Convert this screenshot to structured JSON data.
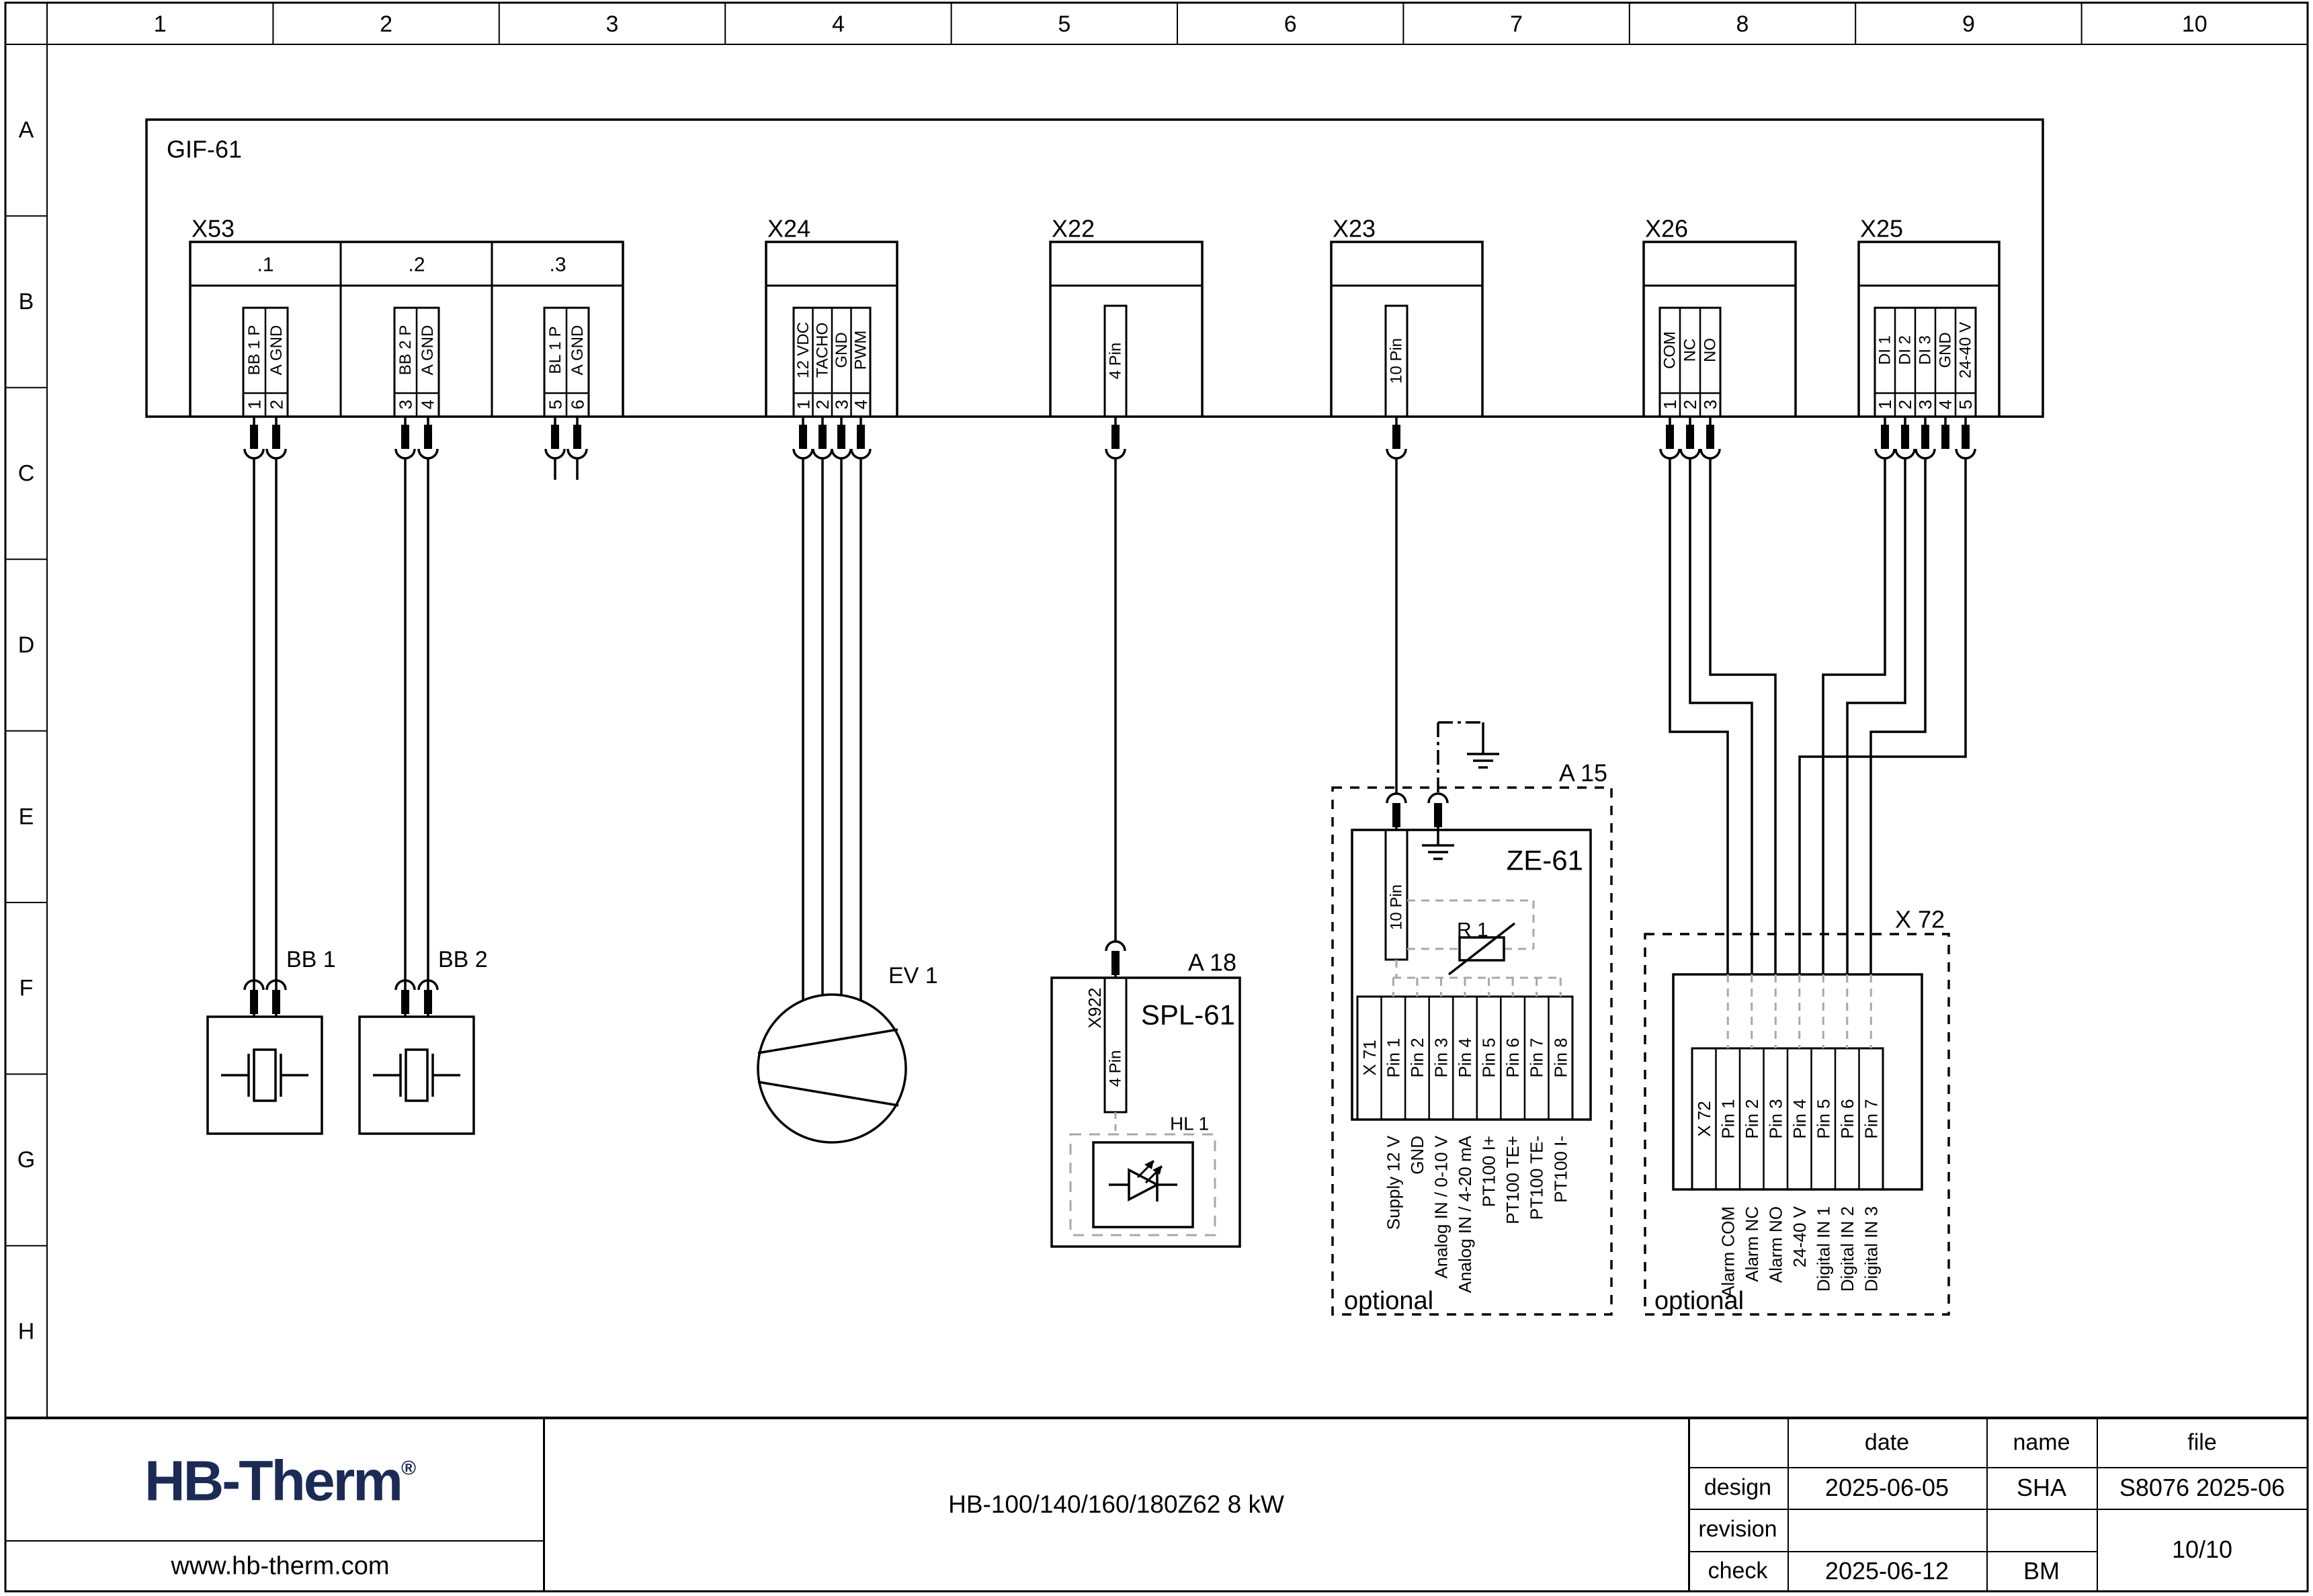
{
  "frame": {
    "columns": [
      "1",
      "2",
      "3",
      "4",
      "5",
      "6",
      "7",
      "8",
      "9",
      "10"
    ],
    "rows": [
      "A",
      "B",
      "C",
      "D",
      "E",
      "F",
      "G",
      "H"
    ]
  },
  "colors": {
    "accent": "#1b2b55",
    "line": "#000000",
    "gray_dash": "#a8a8a8"
  },
  "title_block": {
    "logo_text": "HB-Therm",
    "logo_mark": "®",
    "website": "www.hb-therm.com",
    "product": "HB-100/140/160/180Z62 8 kW",
    "col_date": "date",
    "col_name": "name",
    "col_file": "file",
    "row_design": "design",
    "row_revision": "revision",
    "row_check": "check",
    "design_date": "2025-06-05",
    "design_name": "SHA",
    "file_value": "S8076 2025-06",
    "check_date": "2025-06-12",
    "check_name": "BM",
    "page": "10/10"
  },
  "schematic": {
    "main_unit_label": "GIF-61",
    "connectors": {
      "x53": {
        "label": "X53",
        "groups": [
          {
            "name": ".1",
            "pins": [
              [
                "1",
                "BB 1 P"
              ],
              [
                "2",
                "A GND"
              ]
            ]
          },
          {
            "name": ".2",
            "pins": [
              [
                "3",
                "BB 2 P"
              ],
              [
                "4",
                "A GND"
              ]
            ]
          },
          {
            "name": ".3",
            "pins": [
              [
                "5",
                "BL 1 P"
              ],
              [
                "6",
                "A GND"
              ]
            ]
          }
        ]
      },
      "x24": {
        "label": "X24",
        "pins": [
          [
            "1",
            "12 VDC"
          ],
          [
            "2",
            "TACHO"
          ],
          [
            "3",
            "GND"
          ],
          [
            "4",
            "PWM"
          ]
        ]
      },
      "x22": {
        "label": "X22",
        "pin_note": "4 Pin"
      },
      "x23": {
        "label": "X23",
        "pin_note": "10 Pin"
      },
      "x26": {
        "label": "X26",
        "pins": [
          [
            "1",
            "COM"
          ],
          [
            "2",
            "NC"
          ],
          [
            "3",
            "NO"
          ]
        ]
      },
      "x25": {
        "label": "X25",
        "pins": [
          [
            "1",
            "DI 1"
          ],
          [
            "2",
            "DI 2"
          ],
          [
            "3",
            "DI 3"
          ],
          [
            "4",
            "GND"
          ],
          [
            "5",
            "24-40 V"
          ]
        ]
      }
    },
    "components": {
      "bb1": "BB 1",
      "bb2": "BB 2",
      "ev1": "EV 1"
    },
    "a18": {
      "label": "A 18",
      "board": "SPL-61",
      "connector": "X922",
      "pin_note": "4 Pin",
      "lamp": "HL 1"
    },
    "a15": {
      "label": "A 15",
      "board": "ZE-61",
      "pin_note": "10 Pin",
      "resistor": "R 1",
      "optional": "optional",
      "terminal": "X 71",
      "pins": [
        "Pin 1",
        "Pin 2",
        "Pin 3",
        "Pin 4",
        "Pin 5",
        "Pin 6",
        "Pin 7",
        "Pin 8"
      ],
      "signals": [
        "Supply 12 V",
        "GND",
        "Analog IN / 0-10 V",
        "Analog IN / 4-20 mA",
        "PT100 I+",
        "PT100 TE+",
        "PT100 TE-",
        "PT100 I-"
      ]
    },
    "x72": {
      "label": "X 72",
      "optional": "optional",
      "terminal": "X 72",
      "pins": [
        "Pin 1",
        "Pin 2",
        "Pin 3",
        "Pin 4",
        "Pin 5",
        "Pin 6",
        "Pin 7"
      ],
      "signals": [
        "Alarm COM",
        "Alarm NC",
        "Alarm NO",
        "24-40 V",
        "Digital IN 1",
        "Digital IN 2",
        "Digital IN 3"
      ]
    }
  }
}
